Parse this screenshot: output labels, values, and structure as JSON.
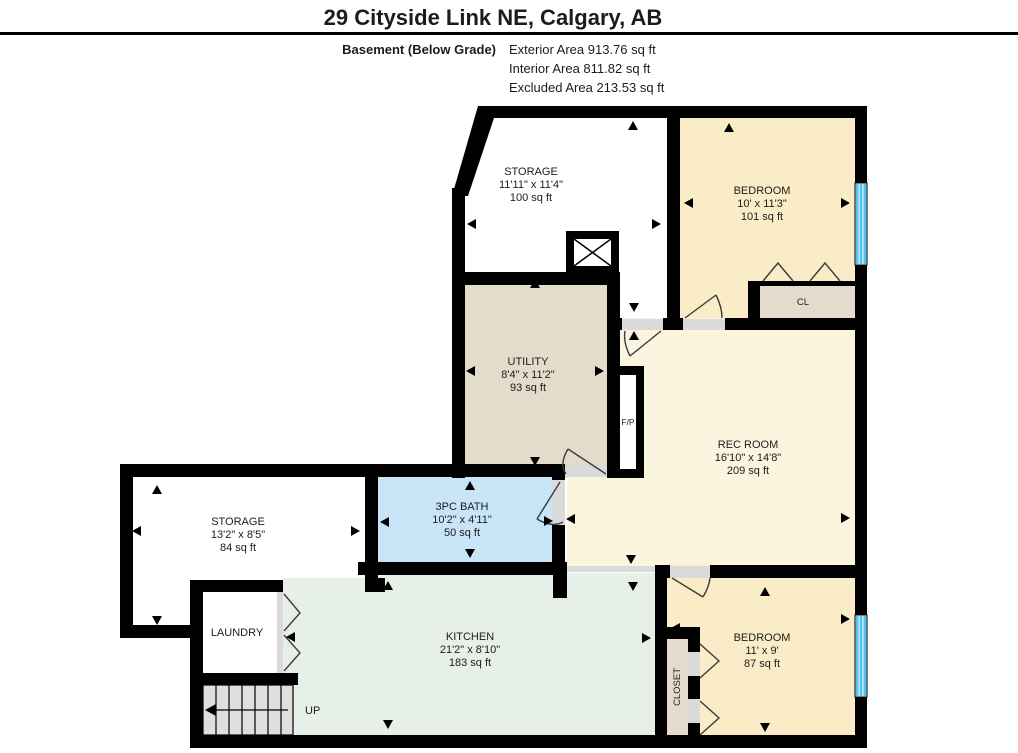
{
  "header": {
    "title": "29 Cityside Link NE, Calgary, AB",
    "floor_label": "Basement (Below Grade)",
    "area_lines": [
      "Exterior Area 913.76 sq ft",
      "Interior Area 811.82 sq ft",
      "Excluded Area 213.53 sq ft"
    ]
  },
  "rooms": {
    "storage_top": {
      "name": "STORAGE",
      "dims": "11'11\" x 11'4\"",
      "area": "100 sq ft"
    },
    "bedroom_top": {
      "name": "BEDROOM",
      "dims": "10' x 11'3\"",
      "area": "101 sq ft"
    },
    "utility": {
      "name": "UTILITY",
      "dims": "8'4\" x 11'2\"",
      "area": "93 sq ft"
    },
    "rec_room": {
      "name": "REC ROOM",
      "dims": "16'10\" x 14'8\"",
      "area": "209 sq ft"
    },
    "storage_left": {
      "name": "STORAGE",
      "dims": "13'2\" x 8'5\"",
      "area": "84 sq ft"
    },
    "bath": {
      "name": "3PC BATH",
      "dims": "10'2\" x 4'11\"",
      "area": "50 sq ft"
    },
    "laundry": {
      "name": "LAUNDRY"
    },
    "kitchen": {
      "name": "KITCHEN",
      "dims": "21'2\" x 8'10\"",
      "area": "183 sq ft"
    },
    "bedroom_bottom": {
      "name": "BEDROOM",
      "dims": "11' x 9'",
      "area": "87 sq ft"
    },
    "closet_top": {
      "name": "CL"
    },
    "closet_bottom": {
      "name": "CLOSET"
    },
    "fireplace": {
      "name": "F/P"
    },
    "stairs": {
      "name": "UP"
    }
  },
  "colors": {
    "wall": "#000000",
    "bedroom": "#F9ECC6",
    "rec": "#FBF4DE",
    "utility": "#E4DCCB",
    "bath": "#C8E4F7",
    "kitchen": "#E6F0E8",
    "closet": "#E3DCCC",
    "stairs": "#DFDFDF",
    "threshold": "#DADADA",
    "window": "#54C2EE"
  }
}
